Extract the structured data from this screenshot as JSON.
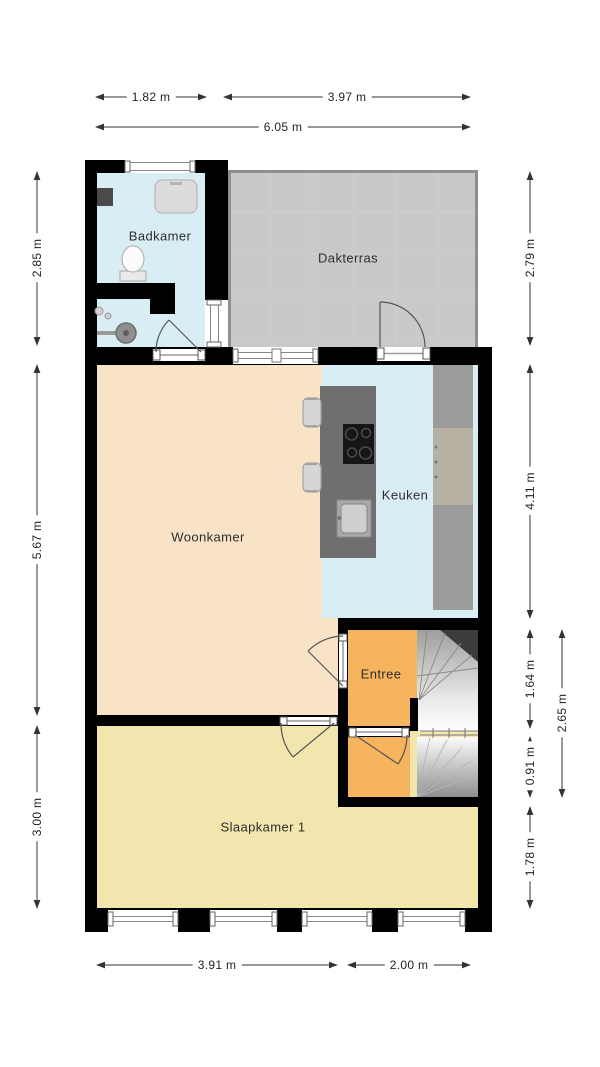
{
  "rooms": {
    "badkamer": "Badkamer",
    "dakterras": "Dakterras",
    "woonkamer": "Woonkamer",
    "keuken": "Keuken",
    "entree": "Entree",
    "slaapkamer1": "Slaapkamer 1"
  },
  "dimensions": {
    "top": {
      "badkamer_width": "1.82 m",
      "dakterras_width": "3.97 m",
      "total_width": "6.05 m"
    },
    "left": {
      "badkamer_height": "2.85 m",
      "woonkamer_height": "5.67 m",
      "slaapkamer_height": "3.00 m"
    },
    "right": {
      "dakterras_height": "2.79 m",
      "keuken_height": "4.11 m",
      "entree_height": "1.64 m",
      "hal_height": "0.91 m",
      "rear_section_height": "1.78 m",
      "entree_total_height": "2.65 m"
    },
    "bottom": {
      "slaapkamer_width": "3.91 m",
      "entree_section_width": "2.00 m"
    }
  },
  "colors": {
    "wall": "#000000",
    "badkamer": "#d9edf4",
    "dakterras": "#c9c9c9",
    "woonkamer": "#f8e3c7",
    "keuken": "#d9edf4",
    "entree": "#f6b45f",
    "slaapkamer": "#f3e5ae",
    "island": "#6f6f6f",
    "counter": "#9b9b9b",
    "counter_accent": "#b7b1a4",
    "stair_dark": "#3c3c3c",
    "dim_line": "#333333"
  },
  "fixtures": [
    "toilet",
    "washbasin",
    "shower",
    "shaft",
    "cooktop",
    "kitchen-sink",
    "bar-stools",
    "stairs-up",
    "stairs-down"
  ]
}
